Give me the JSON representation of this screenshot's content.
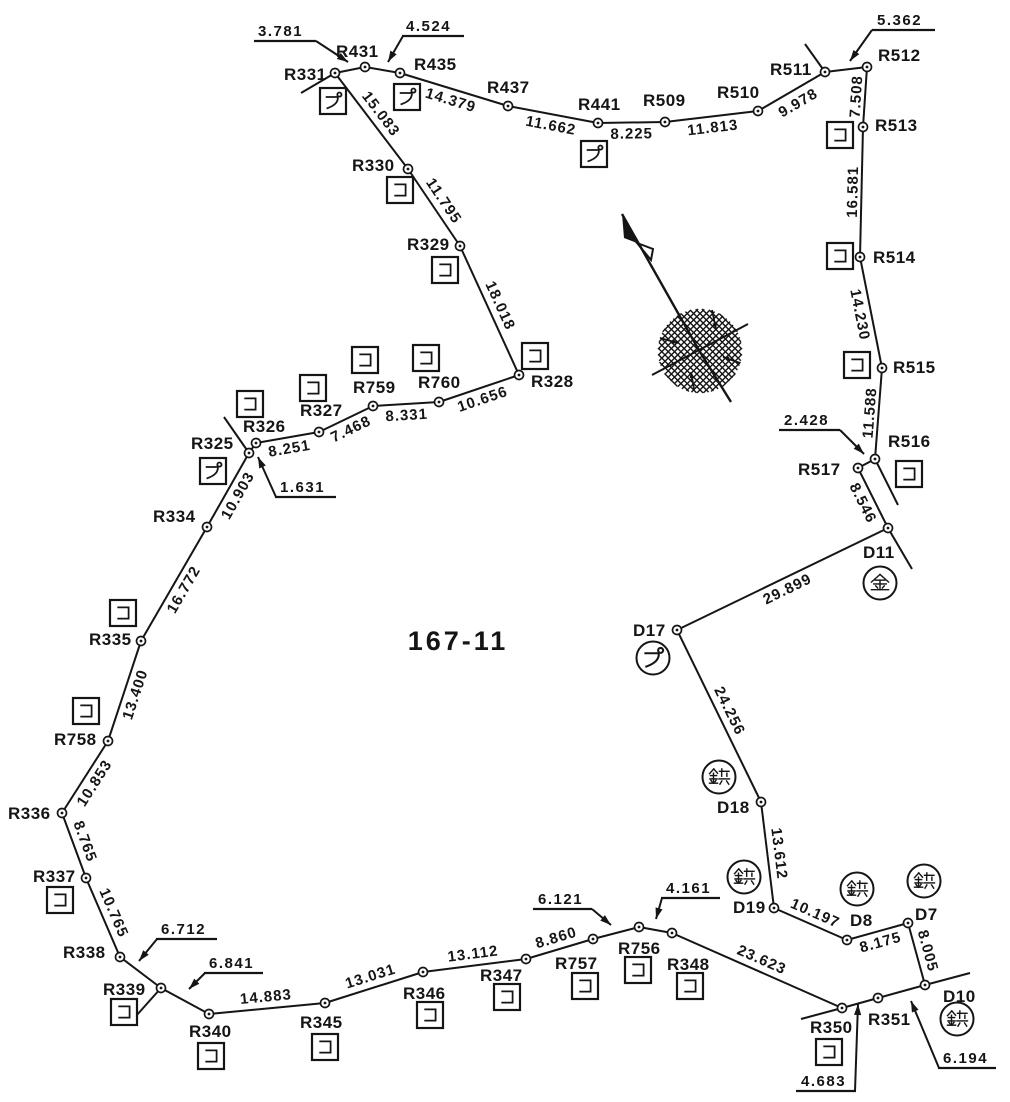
{
  "title": "167-11",
  "colors": {
    "ink": "#151515",
    "bg": "#ffffff"
  },
  "canvas": {
    "w": 1010,
    "h": 1102
  },
  "parcel_label": {
    "text": "167-11",
    "x": 458,
    "y": 650
  },
  "points": [
    {
      "id": "R331",
      "x": 335,
      "y": 73,
      "lx": 284,
      "ly": 80
    },
    {
      "id": "R431",
      "x": 365,
      "y": 67,
      "lx": 336,
      "ly": 57
    },
    {
      "id": "R435",
      "x": 400,
      "y": 73,
      "lx": 414,
      "ly": 70
    },
    {
      "id": "R437",
      "x": 508,
      "y": 106,
      "lx": 487,
      "ly": 93
    },
    {
      "id": "R441",
      "x": 598,
      "y": 123,
      "lx": 578,
      "ly": 110
    },
    {
      "id": "R509",
      "x": 665,
      "y": 122,
      "lx": 643,
      "ly": 106
    },
    {
      "id": "R510",
      "x": 758,
      "y": 111,
      "lx": 717,
      "ly": 98
    },
    {
      "id": "R511",
      "x": 825,
      "y": 72,
      "lx": 770,
      "ly": 75
    },
    {
      "id": "R512",
      "x": 867,
      "y": 67,
      "lx": 878,
      "ly": 61
    },
    {
      "id": "R513",
      "x": 863,
      "y": 127,
      "lx": 875,
      "ly": 131
    },
    {
      "id": "R514",
      "x": 860,
      "y": 257,
      "lx": 873,
      "ly": 263
    },
    {
      "id": "R515",
      "x": 882,
      "y": 368,
      "lx": 893,
      "ly": 373
    },
    {
      "id": "R516",
      "x": 875,
      "y": 459,
      "lx": 888,
      "ly": 447
    },
    {
      "id": "R517",
      "x": 858,
      "y": 468,
      "lx": 798,
      "ly": 475
    },
    {
      "id": "D11",
      "x": 888,
      "y": 528,
      "lx": 863,
      "ly": 558
    },
    {
      "id": "D17",
      "x": 677,
      "y": 630,
      "lx": 633,
      "ly": 636
    },
    {
      "id": "D18",
      "x": 761,
      "y": 802,
      "lx": 717,
      "ly": 813
    },
    {
      "id": "D19",
      "x": 774,
      "y": 908,
      "lx": 733,
      "ly": 913
    },
    {
      "id": "D8",
      "x": 847,
      "y": 940,
      "lx": 850,
      "ly": 926
    },
    {
      "id": "D7",
      "x": 908,
      "y": 923,
      "lx": 915,
      "ly": 920
    },
    {
      "id": "D10",
      "x": 925,
      "y": 985,
      "lx": 943,
      "ly": 1002
    },
    {
      "id": "R351",
      "x": 878,
      "y": 998,
      "lx": 868,
      "ly": 1025
    },
    {
      "id": "R350",
      "x": 842,
      "y": 1008,
      "lx": 810,
      "ly": 1033
    },
    {
      "id": "R348",
      "x": 672,
      "y": 933,
      "lx": 667,
      "ly": 970
    },
    {
      "id": "R756",
      "x": 639,
      "y": 927,
      "lx": 618,
      "ly": 954
    },
    {
      "id": "R757",
      "x": 593,
      "y": 939,
      "lx": 555,
      "ly": 969
    },
    {
      "id": "R347",
      "x": 526,
      "y": 959,
      "lx": 480,
      "ly": 981
    },
    {
      "id": "R346",
      "x": 423,
      "y": 972,
      "lx": 403,
      "ly": 999
    },
    {
      "id": "R345",
      "x": 325,
      "y": 1003,
      "lx": 300,
      "ly": 1028
    },
    {
      "id": "R340",
      "x": 209,
      "y": 1014,
      "lx": 189,
      "ly": 1037
    },
    {
      "id": "R339",
      "x": 161,
      "y": 988,
      "lx": 103,
      "ly": 995
    },
    {
      "id": "R338",
      "x": 120,
      "y": 957,
      "lx": 63,
      "ly": 958
    },
    {
      "id": "R337",
      "x": 86,
      "y": 878,
      "lx": 33,
      "ly": 882
    },
    {
      "id": "R336",
      "x": 62,
      "y": 813,
      "lx": 8,
      "ly": 819
    },
    {
      "id": "R758",
      "x": 108,
      "y": 741,
      "lx": 54,
      "ly": 745
    },
    {
      "id": "R335",
      "x": 141,
      "y": 641,
      "lx": 89,
      "ly": 645
    },
    {
      "id": "R334",
      "x": 207,
      "y": 527,
      "lx": 153,
      "ly": 522
    },
    {
      "id": "R325",
      "x": 249,
      "y": 453,
      "lx": 191,
      "ly": 449
    },
    {
      "id": "R326",
      "x": 256,
      "y": 443,
      "lx": 243,
      "ly": 432
    },
    {
      "id": "R327",
      "x": 319,
      "y": 432,
      "lx": 300,
      "ly": 416
    },
    {
      "id": "R759",
      "x": 373,
      "y": 406,
      "lx": 353,
      "ly": 393
    },
    {
      "id": "R760",
      "x": 439,
      "y": 402,
      "lx": 418,
      "ly": 388
    },
    {
      "id": "R328",
      "x": 519,
      "y": 375,
      "lx": 531,
      "ly": 387
    },
    {
      "id": "R329",
      "x": 460,
      "y": 246,
      "lx": 407,
      "ly": 250
    },
    {
      "id": "R330",
      "x": 408,
      "y": 169,
      "lx": 352,
      "ly": 171
    }
  ],
  "edges": [
    {
      "a": "R331",
      "b": "R431"
    },
    {
      "a": "R431",
      "b": "R435"
    },
    {
      "a": "R435",
      "b": "R437",
      "label": "14.379",
      "off": 16
    },
    {
      "a": "R437",
      "b": "R441",
      "label": "11.662",
      "off": 16
    },
    {
      "a": "R441",
      "b": "R509",
      "label": "8.225",
      "off": 16
    },
    {
      "a": "R509",
      "b": "R510",
      "label": "11.813",
      "off": 16
    },
    {
      "a": "R510",
      "b": "R511",
      "label": "9.978",
      "off": 18
    },
    {
      "a": "R511",
      "b": "R512"
    },
    {
      "a": "R512",
      "b": "R513",
      "label": "7.508",
      "off": -4
    },
    {
      "a": "R513",
      "b": "R514",
      "label": "16.581",
      "off": -4
    },
    {
      "a": "R514",
      "b": "R515",
      "label": "14.230",
      "off": 16
    },
    {
      "a": "R515",
      "b": "R516",
      "label": "11.588",
      "off": -4
    },
    {
      "a": "R516",
      "b": "R517"
    },
    {
      "a": "R517",
      "b": "D11",
      "label": "8.546",
      "off": 16
    },
    {
      "a": "D11",
      "b": "D17",
      "label": "29.899",
      "off": 16
    },
    {
      "a": "D17",
      "b": "D18",
      "label": "24.256",
      "off": -7
    },
    {
      "a": "D18",
      "b": "D19",
      "label": "13.612",
      "off": -7
    },
    {
      "a": "D19",
      "b": "D8",
      "label": "10.197",
      "off": -7
    },
    {
      "a": "D8",
      "b": "D7",
      "label": "8.175",
      "off": 16
    },
    {
      "a": "D7",
      "b": "D10",
      "label": "8.005",
      "off": -7
    },
    {
      "a": "D10",
      "b": "R351"
    },
    {
      "a": "R351",
      "b": "R350"
    },
    {
      "a": "R350",
      "b": "R348",
      "label": "23.623",
      "off": -7
    },
    {
      "a": "R348",
      "b": "R756"
    },
    {
      "a": "R756",
      "b": "R757"
    },
    {
      "a": "R757",
      "b": "R347",
      "label": "8.860",
      "off": -7
    },
    {
      "a": "R347",
      "b": "R346",
      "label": "13.112",
      "off": -7
    },
    {
      "a": "R346",
      "b": "R345",
      "label": "13.031",
      "off": -7
    },
    {
      "a": "R345",
      "b": "R340",
      "label": "14.883",
      "off": -7
    },
    {
      "a": "R340",
      "b": "R339"
    },
    {
      "a": "R339",
      "b": "R338"
    },
    {
      "a": "R338",
      "b": "R337",
      "label": "10.765",
      "off": -7
    },
    {
      "a": "R337",
      "b": "R336",
      "label": "8.765",
      "off": -7
    },
    {
      "a": "R336",
      "b": "R758",
      "label": "10.853",
      "off": 16
    },
    {
      "a": "R758",
      "b": "R335",
      "label": "13.400",
      "off": 16
    },
    {
      "a": "R335",
      "b": "R334",
      "label": "16.772",
      "off": 16
    },
    {
      "a": "R334",
      "b": "R325",
      "label": "10.903",
      "off": 16
    },
    {
      "a": "R325",
      "b": "R326"
    },
    {
      "a": "R326",
      "b": "R327",
      "label": "8.251",
      "off": 16
    },
    {
      "a": "R327",
      "b": "R759",
      "label": "7.468",
      "off": 16
    },
    {
      "a": "R759",
      "b": "R760",
      "label": "8.331",
      "off": 16
    },
    {
      "a": "R760",
      "b": "R328",
      "label": "10.656",
      "off": 16
    },
    {
      "a": "R328",
      "b": "R329",
      "label": "18.018",
      "off": -7
    },
    {
      "a": "R329",
      "b": "R330",
      "label": "11.795",
      "off": -7
    },
    {
      "a": "R330",
      "b": "R331",
      "label": "15.083",
      "off": -7
    }
  ],
  "spurs": [
    {
      "x1": 335,
      "y1": 73,
      "x2": 301,
      "y2": 93
    },
    {
      "x1": 825,
      "y1": 72,
      "x2": 805,
      "y2": 44
    },
    {
      "x1": 875,
      "y1": 459,
      "x2": 898,
      "y2": 505
    },
    {
      "x1": 888,
      "y1": 528,
      "x2": 912,
      "y2": 569
    },
    {
      "x1": 925,
      "y1": 985,
      "x2": 970,
      "y2": 973
    },
    {
      "x1": 842,
      "y1": 1008,
      "x2": 801,
      "y2": 1019
    },
    {
      "x1": 161,
      "y1": 988,
      "x2": 136,
      "y2": 1016
    },
    {
      "x1": 249,
      "y1": 453,
      "x2": 224,
      "y2": 417
    }
  ],
  "leaders": [
    {
      "text": "3.781",
      "tx": 258,
      "ty": 36,
      "u1": 254,
      "u2": 316,
      "uy": 41,
      "sx": 316,
      "sy": 41,
      "ax": 348,
      "ay": 62
    },
    {
      "text": "4.524",
      "tx": 406,
      "ty": 31,
      "u1": 402,
      "u2": 464,
      "uy": 36,
      "sx": 403,
      "sy": 36,
      "ax": 388,
      "ay": 62
    },
    {
      "text": "5.362",
      "tx": 877,
      "ty": 25,
      "u1": 872,
      "u2": 935,
      "uy": 30,
      "sx": 872,
      "sy": 30,
      "ax": 850,
      "ay": 61
    },
    {
      "text": "2.428",
      "tx": 784,
      "ty": 425,
      "u1": 779,
      "u2": 840,
      "uy": 430,
      "sx": 840,
      "sy": 430,
      "ax": 864,
      "ay": 454
    },
    {
      "text": "1.631",
      "tx": 280,
      "ty": 492,
      "u1": 275,
      "u2": 336,
      "uy": 497,
      "sx": 276,
      "sy": 497,
      "ax": 258,
      "ay": 457
    },
    {
      "text": "6.712",
      "tx": 161,
      "ty": 934,
      "u1": 156,
      "u2": 217,
      "uy": 939,
      "sx": 157,
      "sy": 939,
      "ax": 139,
      "ay": 961
    },
    {
      "text": "6.841",
      "tx": 209,
      "ty": 968,
      "u1": 204,
      "u2": 263,
      "uy": 973,
      "sx": 205,
      "sy": 973,
      "ax": 189,
      "ay": 989
    },
    {
      "text": "6.121",
      "tx": 538,
      "ty": 904,
      "u1": 533,
      "u2": 592,
      "uy": 909,
      "sx": 592,
      "sy": 909,
      "ax": 611,
      "ay": 925
    },
    {
      "text": "4.161",
      "tx": 666,
      "ty": 893,
      "u1": 661,
      "u2": 720,
      "uy": 898,
      "sx": 662,
      "sy": 898,
      "ax": 656,
      "ay": 919
    },
    {
      "text": "4.683",
      "tx": 801,
      "ty": 1086,
      "u1": 796,
      "u2": 856,
      "uy": 1091,
      "sx": 855,
      "sy": 1091,
      "ax": 858,
      "ay": 1004
    },
    {
      "text": "6.194",
      "tx": 943,
      "ty": 1063,
      "u1": 938,
      "u2": 996,
      "uy": 1068,
      "sx": 939,
      "sy": 1068,
      "ax": 911,
      "ay": 1001
    }
  ],
  "markers": [
    {
      "shape": "box",
      "symbol": "pu",
      "char": "プ",
      "x": 333,
      "y": 101
    },
    {
      "shape": "box",
      "symbol": "pu",
      "char": "プ",
      "x": 407,
      "y": 97
    },
    {
      "shape": "box",
      "symbol": "pu",
      "char": "プ",
      "x": 594,
      "y": 154
    },
    {
      "shape": "box",
      "symbol": "ko",
      "char": "コ",
      "x": 840,
      "y": 135
    },
    {
      "shape": "box",
      "symbol": "ko",
      "char": "コ",
      "x": 840,
      "y": 256
    },
    {
      "shape": "box",
      "symbol": "ko",
      "char": "コ",
      "x": 857,
      "y": 365
    },
    {
      "shape": "box",
      "symbol": "ko",
      "char": "コ",
      "x": 909,
      "y": 474
    },
    {
      "shape": "circle",
      "symbol": "kin",
      "char": "金",
      "x": 880,
      "y": 583
    },
    {
      "shape": "circle",
      "symbol": "pu",
      "char": "プ",
      "x": 653,
      "y": 658
    },
    {
      "shape": "circle",
      "symbol": "byo",
      "char": "鋲",
      "x": 719,
      "y": 777
    },
    {
      "shape": "circle",
      "symbol": "byo",
      "char": "鋲",
      "x": 744,
      "y": 877
    },
    {
      "shape": "circle",
      "symbol": "byo",
      "char": "鋲",
      "x": 857,
      "y": 889
    },
    {
      "shape": "circle",
      "symbol": "byo",
      "char": "鋲",
      "x": 924,
      "y": 881
    },
    {
      "shape": "circle",
      "symbol": "byo",
      "char": "鋲",
      "x": 957,
      "y": 1019
    },
    {
      "shape": "box",
      "symbol": "ko",
      "char": "コ",
      "x": 829,
      "y": 1052
    },
    {
      "shape": "box",
      "symbol": "ko",
      "char": "コ",
      "x": 690,
      "y": 986
    },
    {
      "shape": "box",
      "symbol": "ko",
      "char": "コ",
      "x": 638,
      "y": 970
    },
    {
      "shape": "box",
      "symbol": "ko",
      "char": "コ",
      "x": 585,
      "y": 986
    },
    {
      "shape": "box",
      "symbol": "ko",
      "char": "コ",
      "x": 507,
      "y": 997
    },
    {
      "shape": "box",
      "symbol": "ko",
      "char": "コ",
      "x": 430,
      "y": 1015
    },
    {
      "shape": "box",
      "symbol": "ko",
      "char": "コ",
      "x": 325,
      "y": 1047
    },
    {
      "shape": "box",
      "symbol": "ko",
      "char": "コ",
      "x": 211,
      "y": 1056
    },
    {
      "shape": "box",
      "symbol": "ko",
      "char": "コ",
      "x": 124,
      "y": 1012
    },
    {
      "shape": "box",
      "symbol": "ko",
      "char": "コ",
      "x": 60,
      "y": 900
    },
    {
      "shape": "box",
      "symbol": "ko",
      "char": "コ",
      "x": 86,
      "y": 711
    },
    {
      "shape": "box",
      "symbol": "ko",
      "char": "コ",
      "x": 123,
      "y": 613
    },
    {
      "shape": "box",
      "symbol": "pu",
      "char": "プ",
      "x": 213,
      "y": 471
    },
    {
      "shape": "box",
      "symbol": "ko",
      "char": "コ",
      "x": 250,
      "y": 404
    },
    {
      "shape": "box",
      "symbol": "ko",
      "char": "コ",
      "x": 313,
      "y": 388
    },
    {
      "shape": "box",
      "symbol": "ko",
      "char": "コ",
      "x": 365,
      "y": 360
    },
    {
      "shape": "box",
      "symbol": "ko",
      "char": "コ",
      "x": 426,
      "y": 358
    },
    {
      "shape": "box",
      "symbol": "ko",
      "char": "コ",
      "x": 535,
      "y": 356
    },
    {
      "shape": "box",
      "symbol": "ko",
      "char": "コ",
      "x": 445,
      "y": 270
    },
    {
      "shape": "box",
      "symbol": "ko",
      "char": "コ",
      "x": 400,
      "y": 190
    }
  ],
  "north_arrow": {
    "shaft": [
      [
        622,
        214
      ],
      [
        700,
        352
      ]
    ],
    "extension": [
      [
        700,
        352
      ],
      [
        731,
        402
      ]
    ],
    "cross_line": [
      [
        652,
        375
      ],
      [
        748,
        324
      ]
    ],
    "flag_solid": [
      [
        622,
        214
      ],
      [
        624,
        238
      ],
      [
        637,
        243
      ]
    ],
    "flag_outline": [
      [
        637,
        243
      ],
      [
        653,
        249
      ],
      [
        651,
        260
      ]
    ],
    "hatch": {
      "cx": 700,
      "cy": 351,
      "r": 42,
      "step": 4.5
    },
    "ticks": [
      {
        "x1": 712,
        "y1": 310,
        "x2": 716,
        "y2": 329
      },
      {
        "x1": 660,
        "y1": 338,
        "x2": 678,
        "y2": 343
      },
      {
        "x1": 740,
        "y1": 363,
        "x2": 723,
        "y2": 357
      },
      {
        "x1": 694,
        "y1": 389,
        "x2": 691,
        "y2": 372
      }
    ]
  }
}
